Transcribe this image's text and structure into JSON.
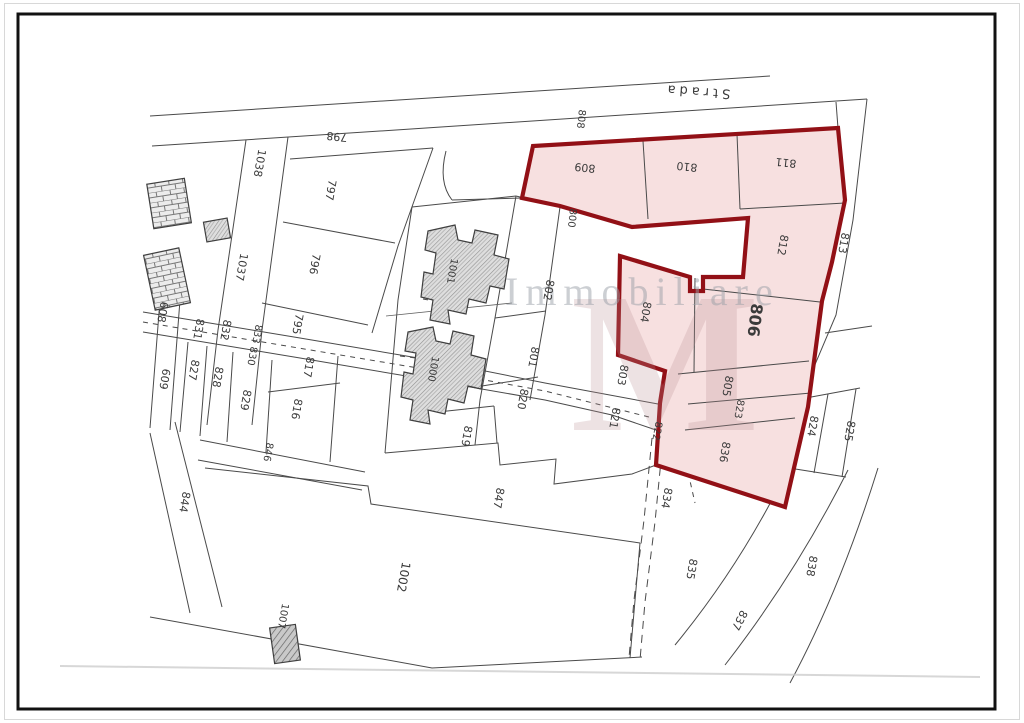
{
  "map": {
    "type": "cadastral-parcel-plan",
    "road": {
      "label": "Strada"
    },
    "watermark": {
      "text": "Immobiliare",
      "monogram": "M"
    },
    "colors": {
      "highlight_stroke": "#921016",
      "highlight_fill": "#f7e0e0",
      "line": "#4a4a4a",
      "label": "#3b3b3b",
      "frame": "#111111",
      "watermark": "#9aa0a8"
    },
    "highlighted_parcels": [
      "809",
      "810",
      "811",
      "812",
      "804",
      "806",
      "805",
      "823",
      "836"
    ],
    "labels": [
      {
        "t": "Strada",
        "x": 697,
        "y": 91,
        "r": 184,
        "s": 13,
        "ls": 4,
        "c": "#58585a"
      },
      {
        "t": "808",
        "x": 581,
        "y": 119,
        "r": 96,
        "s": 10
      },
      {
        "t": "800",
        "x": 572,
        "y": 218,
        "r": 96,
        "s": 10
      },
      {
        "t": "809",
        "x": 585,
        "y": 167,
        "r": 186,
        "s": 11
      },
      {
        "t": "810",
        "x": 687,
        "y": 166,
        "r": 186,
        "s": 11
      },
      {
        "t": "811",
        "x": 786,
        "y": 162,
        "r": 186,
        "s": 11
      },
      {
        "t": "812",
        "x": 782,
        "y": 245,
        "r": 100,
        "s": 11
      },
      {
        "t": "813",
        "x": 843,
        "y": 243,
        "r": 100,
        "s": 11
      },
      {
        "t": "798",
        "x": 337,
        "y": 136,
        "r": 186,
        "s": 11
      },
      {
        "t": "1038",
        "x": 259,
        "y": 163,
        "r": 100,
        "s": 11
      },
      {
        "t": "797",
        "x": 330,
        "y": 190,
        "r": 100,
        "s": 11
      },
      {
        "t": "796",
        "x": 314,
        "y": 264,
        "r": 100,
        "s": 11
      },
      {
        "t": "1037",
        "x": 241,
        "y": 267,
        "r": 100,
        "s": 11
      },
      {
        "t": "795",
        "x": 297,
        "y": 324,
        "r": 100,
        "s": 11
      },
      {
        "t": "817",
        "x": 308,
        "y": 367,
        "r": 100,
        "s": 11
      },
      {
        "t": "816",
        "x": 296,
        "y": 409,
        "r": 100,
        "s": 11
      },
      {
        "t": "829",
        "x": 245,
        "y": 400,
        "r": 100,
        "s": 11
      },
      {
        "t": "828",
        "x": 217,
        "y": 377,
        "r": 100,
        "s": 11
      },
      {
        "t": "827",
        "x": 193,
        "y": 370,
        "r": 100,
        "s": 11
      },
      {
        "t": "831",
        "x": 198,
        "y": 329,
        "r": 100,
        "s": 11
      },
      {
        "t": "832",
        "x": 225,
        "y": 330,
        "r": 100,
        "s": 11
      },
      {
        "t": "833",
        "x": 257,
        "y": 334,
        "r": 100,
        "s": 10
      },
      {
        "t": "830",
        "x": 252,
        "y": 356,
        "r": 100,
        "s": 10
      },
      {
        "t": "609",
        "x": 164,
        "y": 379,
        "r": 100,
        "s": 11
      },
      {
        "t": "608",
        "x": 162,
        "y": 312,
        "r": 100,
        "s": 11
      },
      {
        "t": "1001",
        "x": 452,
        "y": 271,
        "r": 100,
        "s": 10
      },
      {
        "t": "1000",
        "x": 433,
        "y": 369,
        "r": 100,
        "s": 10
      },
      {
        "t": "802",
        "x": 548,
        "y": 290,
        "r": 100,
        "s": 11
      },
      {
        "t": "801",
        "x": 533,
        "y": 357,
        "r": 100,
        "s": 11
      },
      {
        "t": "820",
        "x": 522,
        "y": 399,
        "r": 100,
        "s": 11
      },
      {
        "t": "819",
        "x": 466,
        "y": 436,
        "r": 100,
        "s": 11
      },
      {
        "t": "803",
        "x": 622,
        "y": 375,
        "r": 100,
        "s": 11
      },
      {
        "t": "821",
        "x": 614,
        "y": 418,
        "r": 100,
        "s": 11
      },
      {
        "t": "804",
        "x": 645,
        "y": 312,
        "r": 100,
        "s": 11
      },
      {
        "t": "806",
        "x": 754,
        "y": 320,
        "r": 97,
        "s": 16,
        "b": true
      },
      {
        "t": "805",
        "x": 727,
        "y": 386,
        "r": 100,
        "s": 11
      },
      {
        "t": "823",
        "x": 739,
        "y": 409,
        "r": 100,
        "s": 10
      },
      {
        "t": "822",
        "x": 657,
        "y": 431,
        "r": 100,
        "s": 10
      },
      {
        "t": "836",
        "x": 724,
        "y": 452,
        "r": 100,
        "s": 11
      },
      {
        "t": "824",
        "x": 812,
        "y": 426,
        "r": 100,
        "s": 11
      },
      {
        "t": "825",
        "x": 849,
        "y": 431,
        "r": 100,
        "s": 11
      },
      {
        "t": "834",
        "x": 666,
        "y": 498,
        "r": 100,
        "s": 11
      },
      {
        "t": "835",
        "x": 691,
        "y": 569,
        "r": 100,
        "s": 11
      },
      {
        "t": "837",
        "x": 739,
        "y": 620,
        "r": 118,
        "s": 11
      },
      {
        "t": "838",
        "x": 811,
        "y": 566,
        "r": 100,
        "s": 11
      },
      {
        "t": "844",
        "x": 184,
        "y": 502,
        "r": 100,
        "s": 11
      },
      {
        "t": "846",
        "x": 268,
        "y": 452,
        "r": 100,
        "s": 10
      },
      {
        "t": "847",
        "x": 498,
        "y": 498,
        "r": 100,
        "s": 11
      },
      {
        "t": "1002",
        "x": 403,
        "y": 577,
        "r": 100,
        "s": 12
      },
      {
        "t": "1007",
        "x": 283,
        "y": 616,
        "r": 100,
        "s": 10
      }
    ]
  }
}
